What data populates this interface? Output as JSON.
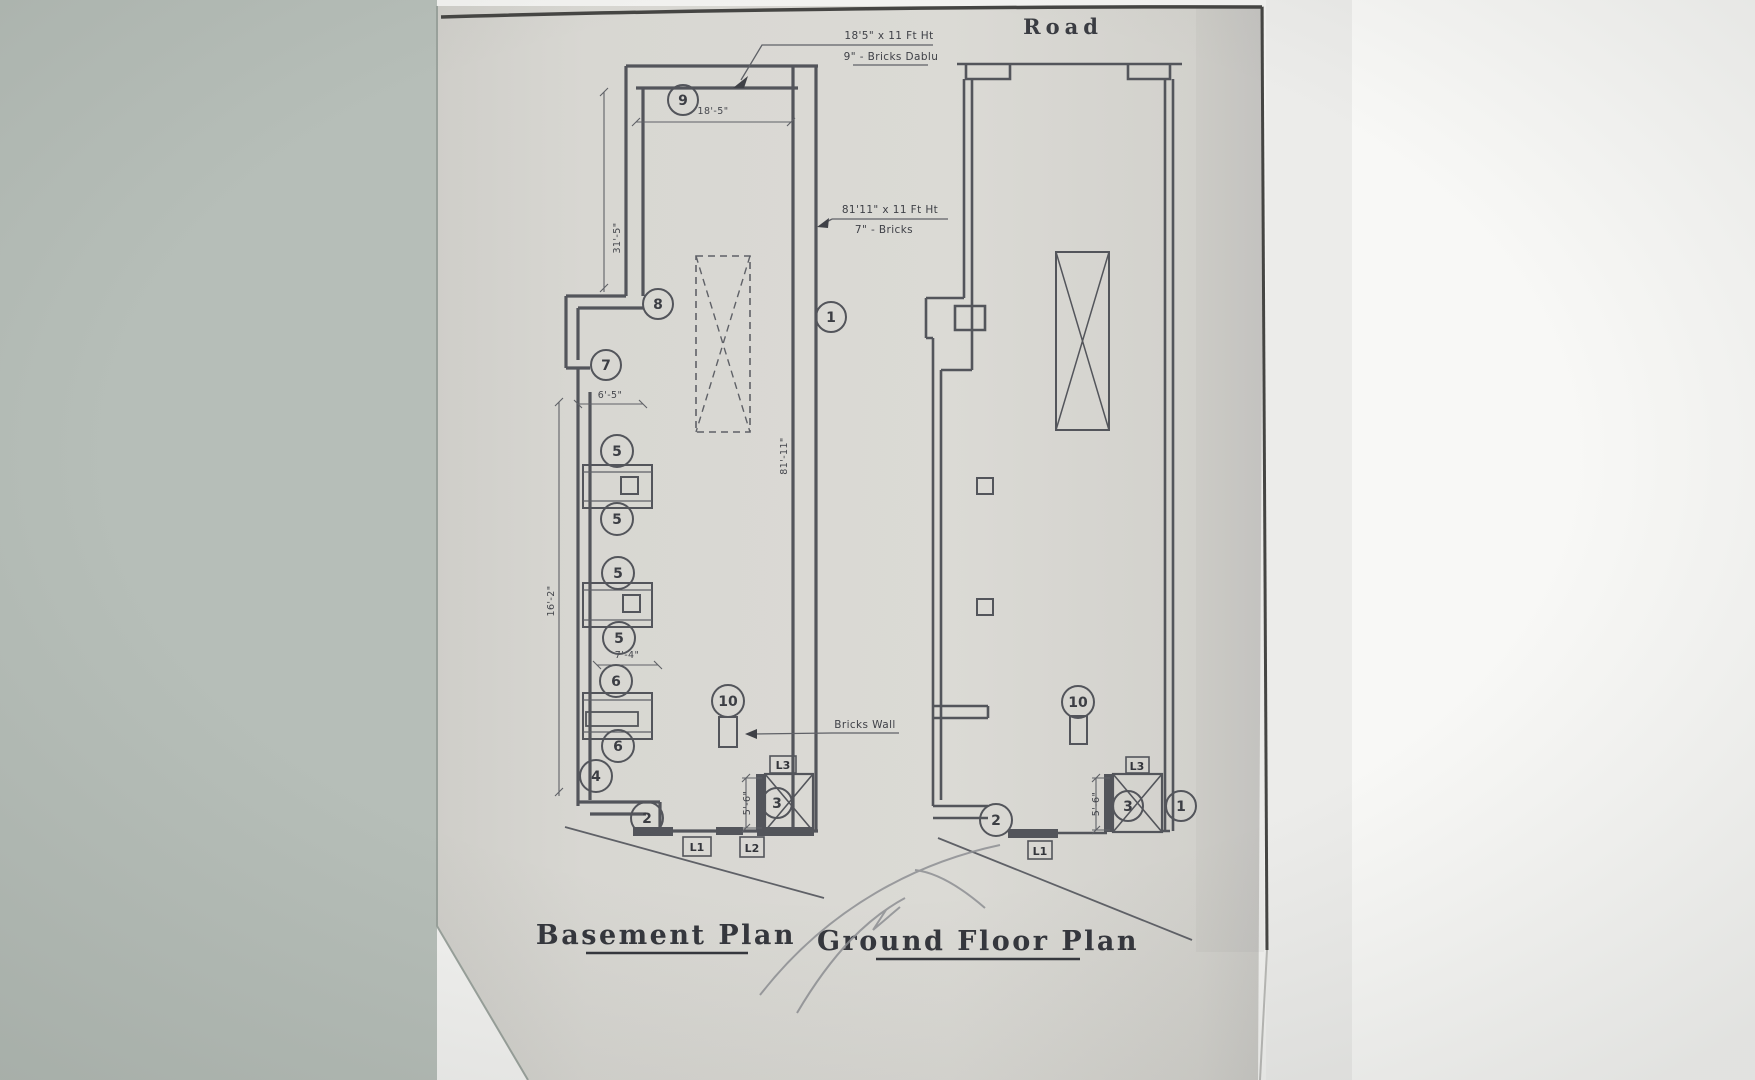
{
  "scene": {
    "road_label": "Road",
    "basement_title": "Basement Plan",
    "ground_title": "Ground Floor Plan"
  },
  "notes": {
    "top_line1": "18'5\" x 11 Ft Ht",
    "top_line2": "9\" - Bricks Dablu",
    "mid_line1": "81'11\" x 11 Ft Ht",
    "mid_line2": "7\" - Bricks",
    "bricks_wall": "Bricks Wall"
  },
  "dims": {
    "top_width": "18'-5\"",
    "upper_left_height": "31'-5\"",
    "notch_width": "6'-5\"",
    "mid_left_height": "16'-2\"",
    "block_width": "7'-4\"",
    "right_height": "81'-11\"",
    "stair_width": "5'-6\""
  },
  "callouts": {
    "c1": "1",
    "c2": "2",
    "c3": "3",
    "c4": "4",
    "c5": "5",
    "c6": "6",
    "c7": "7",
    "c8": "8",
    "c9": "9",
    "c10": "10"
  },
  "lintels": {
    "l1": "L1",
    "l2": "L2",
    "l3": "L3"
  },
  "palette": {
    "background": "#b6beb8",
    "paper": "#d7d6d1",
    "ink": "#53555b",
    "pencil": "#8e9094",
    "paper_edge": "#454543"
  }
}
